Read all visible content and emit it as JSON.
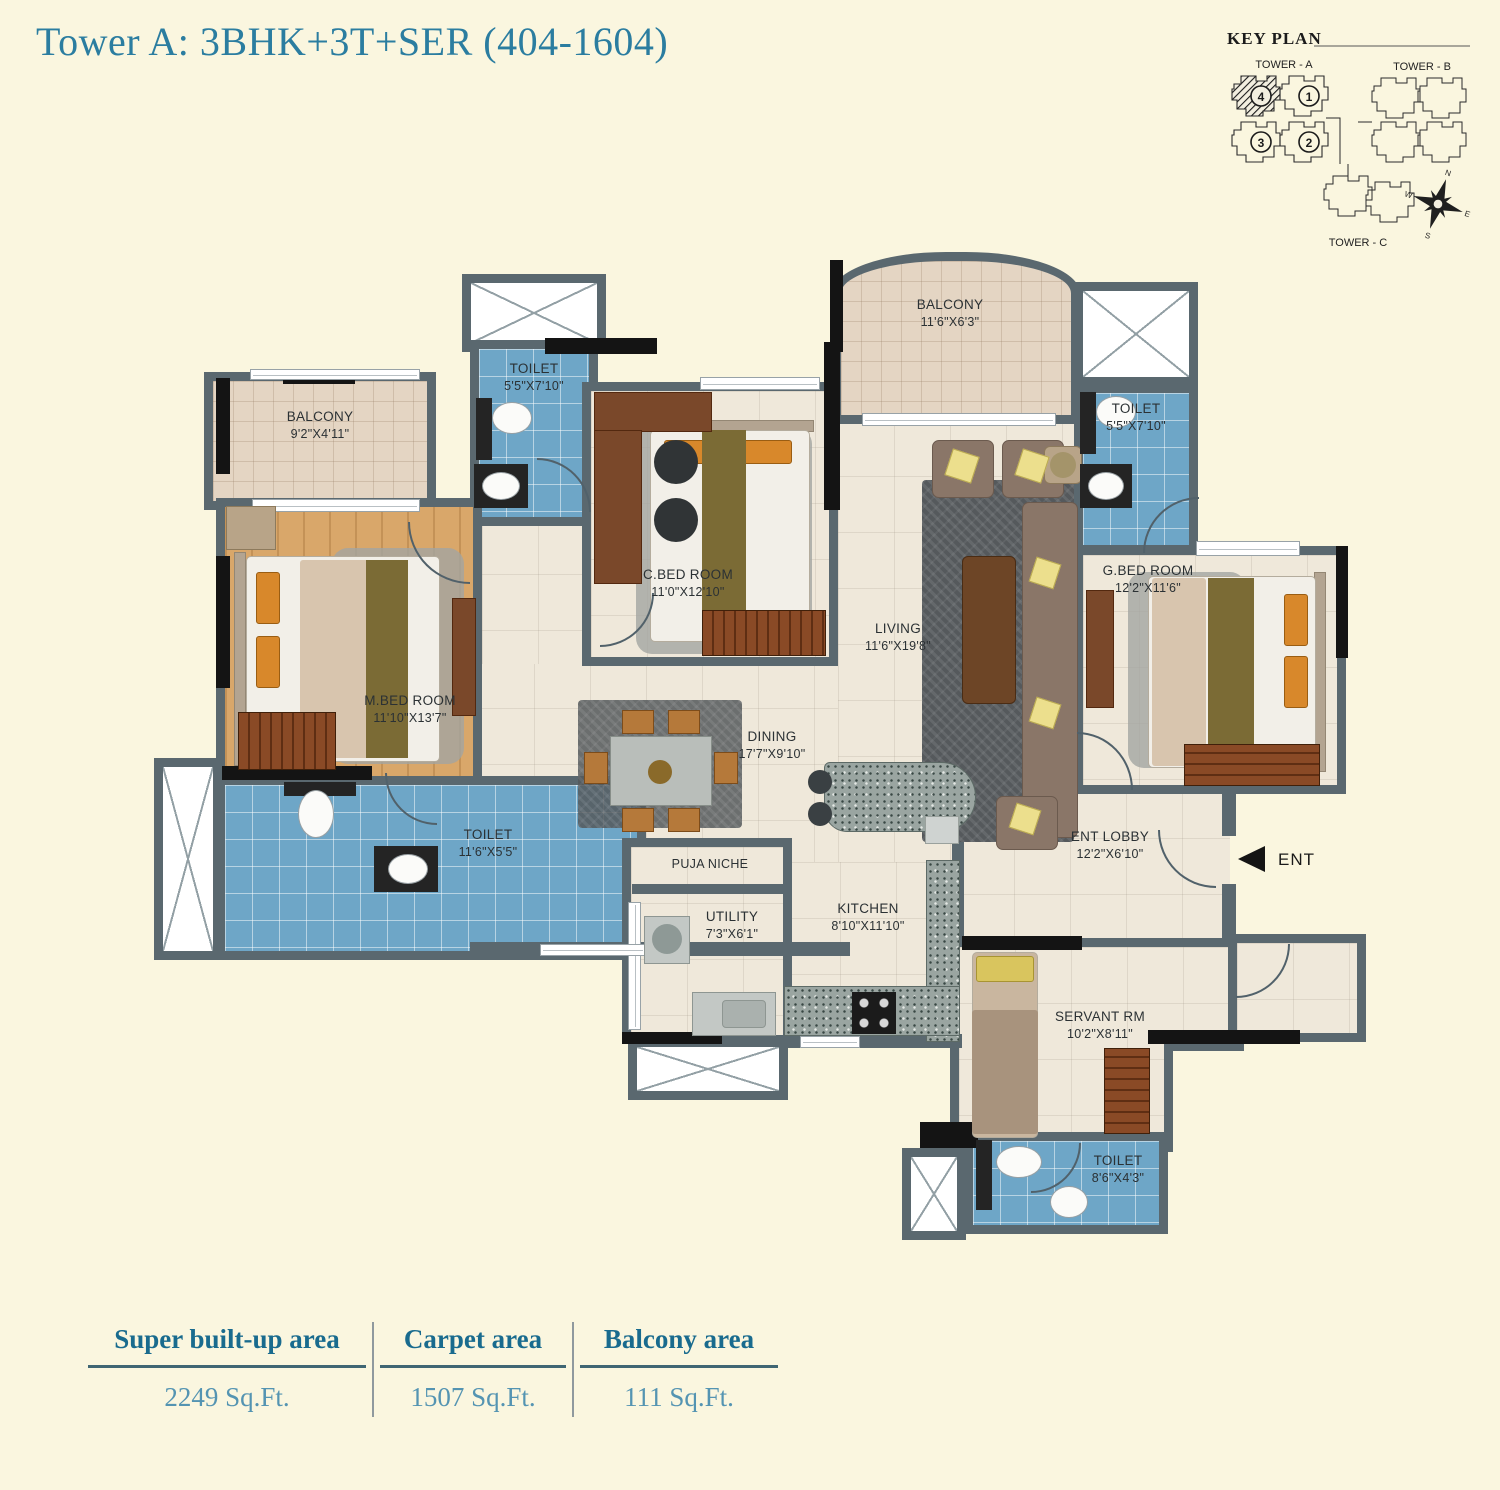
{
  "page": {
    "title": "Tower A: 3BHK+3T+SER (404-1604)"
  },
  "key_plan": {
    "title": "KEY PLAN",
    "tower_a": "TOWER - A",
    "tower_b": "TOWER - B",
    "tower_c": "TOWER - C",
    "units": [
      "1",
      "2",
      "3",
      "4"
    ],
    "highlighted_unit": "4",
    "compass": {
      "n": "N",
      "e": "E",
      "s": "S",
      "w": "W"
    }
  },
  "entrance": {
    "label": "ENT"
  },
  "rooms": [
    {
      "id": "balcony-left",
      "name": "BALCONY",
      "dims": "9'2\"X4'11\""
    },
    {
      "id": "toilet-mbed",
      "name": "TOILET",
      "dims": "5'5\"X7'10\""
    },
    {
      "id": "mbed",
      "name": "M.BED ROOM",
      "dims": "11'10\"X13'7\""
    },
    {
      "id": "toilet-left",
      "name": "TOILET",
      "dims": "11'6\"X5'5\""
    },
    {
      "id": "cbed",
      "name": "C.BED ROOM",
      "dims": "11'0\"X12'10\""
    },
    {
      "id": "balcony-top",
      "name": "BALCONY",
      "dims": "11'6\"X6'3\""
    },
    {
      "id": "living",
      "name": "LIVING",
      "dims": "11'6\"X19'8\""
    },
    {
      "id": "toilet-gbed",
      "name": "TOILET",
      "dims": "5'5\"X7'10\""
    },
    {
      "id": "gbed",
      "name": "G.BED ROOM",
      "dims": "12'2\"X11'6\""
    },
    {
      "id": "dining",
      "name": "DINING",
      "dims": "17'7\"X9'10\""
    },
    {
      "id": "puja",
      "name": "PUJA NICHE",
      "dims": ""
    },
    {
      "id": "utility",
      "name": "UTILITY",
      "dims": "7'3\"X6'1\""
    },
    {
      "id": "kitchen",
      "name": "KITCHEN",
      "dims": "8'10\"X11'10\""
    },
    {
      "id": "ent-lobby",
      "name": "ENT LOBBY",
      "dims": "12'2\"X6'10\""
    },
    {
      "id": "servant",
      "name": "SERVANT RM",
      "dims": "10'2\"X8'11\""
    },
    {
      "id": "toilet-servant",
      "name": "TOILET",
      "dims": "8'6\"X4'3\""
    }
  ],
  "area_table": {
    "columns": [
      {
        "label": "Super built-up area",
        "value": "2249 Sq.Ft."
      },
      {
        "label": "Carpet area",
        "value": "1507 Sq.Ft."
      },
      {
        "label": "Balcony area",
        "value": "111 Sq.Ft."
      }
    ]
  },
  "colors": {
    "background": "#FAF6DF",
    "title": "#2B7DA0",
    "wall": "#5A686F",
    "toilet_tile": "#6EA6C7",
    "balcony_tile": "#E4D5C3",
    "wood_floor": "#D9A76A",
    "marble_floor": "#EFE8DA",
    "table_header": "#196B8E",
    "table_value": "#5494B2"
  }
}
